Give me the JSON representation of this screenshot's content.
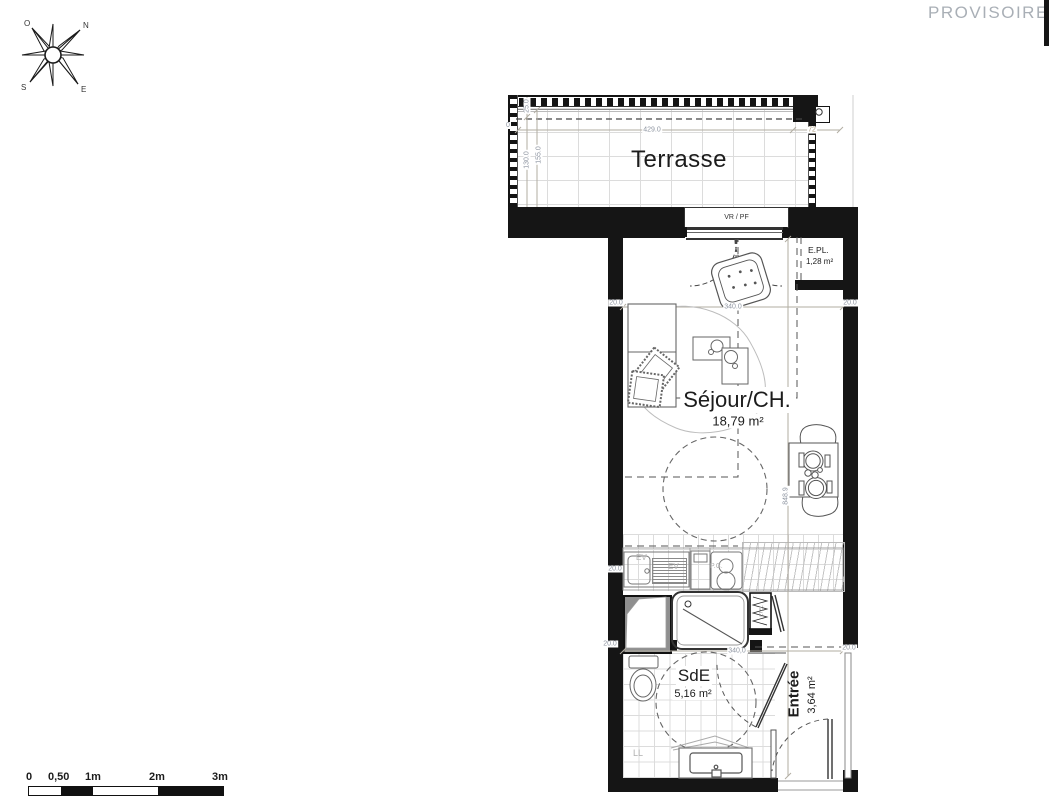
{
  "status_banner": "PROVISOIRE",
  "compass": {
    "west": "O",
    "north": "N",
    "south": "S",
    "east": "E"
  },
  "rooms": {
    "terrasse": {
      "name": "Terrasse"
    },
    "sejour": {
      "name": "Séjour/CH.",
      "area": "18,79 m²"
    },
    "sde": {
      "name": "SdE",
      "area": "5,16 m²"
    },
    "entree": {
      "name": "Entrée",
      "area": "3,64 m²"
    },
    "epl": {
      "name": "E.PL.",
      "area": "1,28 m²"
    }
  },
  "fixtures": {
    "window_label": "VR / PF",
    "etel": "ETEL",
    "washer": "LL",
    "sink": "EV",
    "sink2": "EV",
    "cooktop": "P.C."
  },
  "dimensions": {
    "terrace_width": "429.0",
    "terrace_right": "72",
    "terrace_rail": "25.0",
    "terrace_d1": "130.0",
    "terrace_d2": "155.0",
    "terrace_zero": "0",
    "room_width": "340.0",
    "sde_width": "340,0",
    "apartment_height": "848.9",
    "wall": "20.0"
  },
  "scale_bar": {
    "labels": [
      "0",
      "0,50",
      "1m",
      "2m",
      "3m"
    ]
  },
  "colors": {
    "wall": "#151515",
    "dim_text": "#8e95a1",
    "muted": "#a9afb6"
  }
}
